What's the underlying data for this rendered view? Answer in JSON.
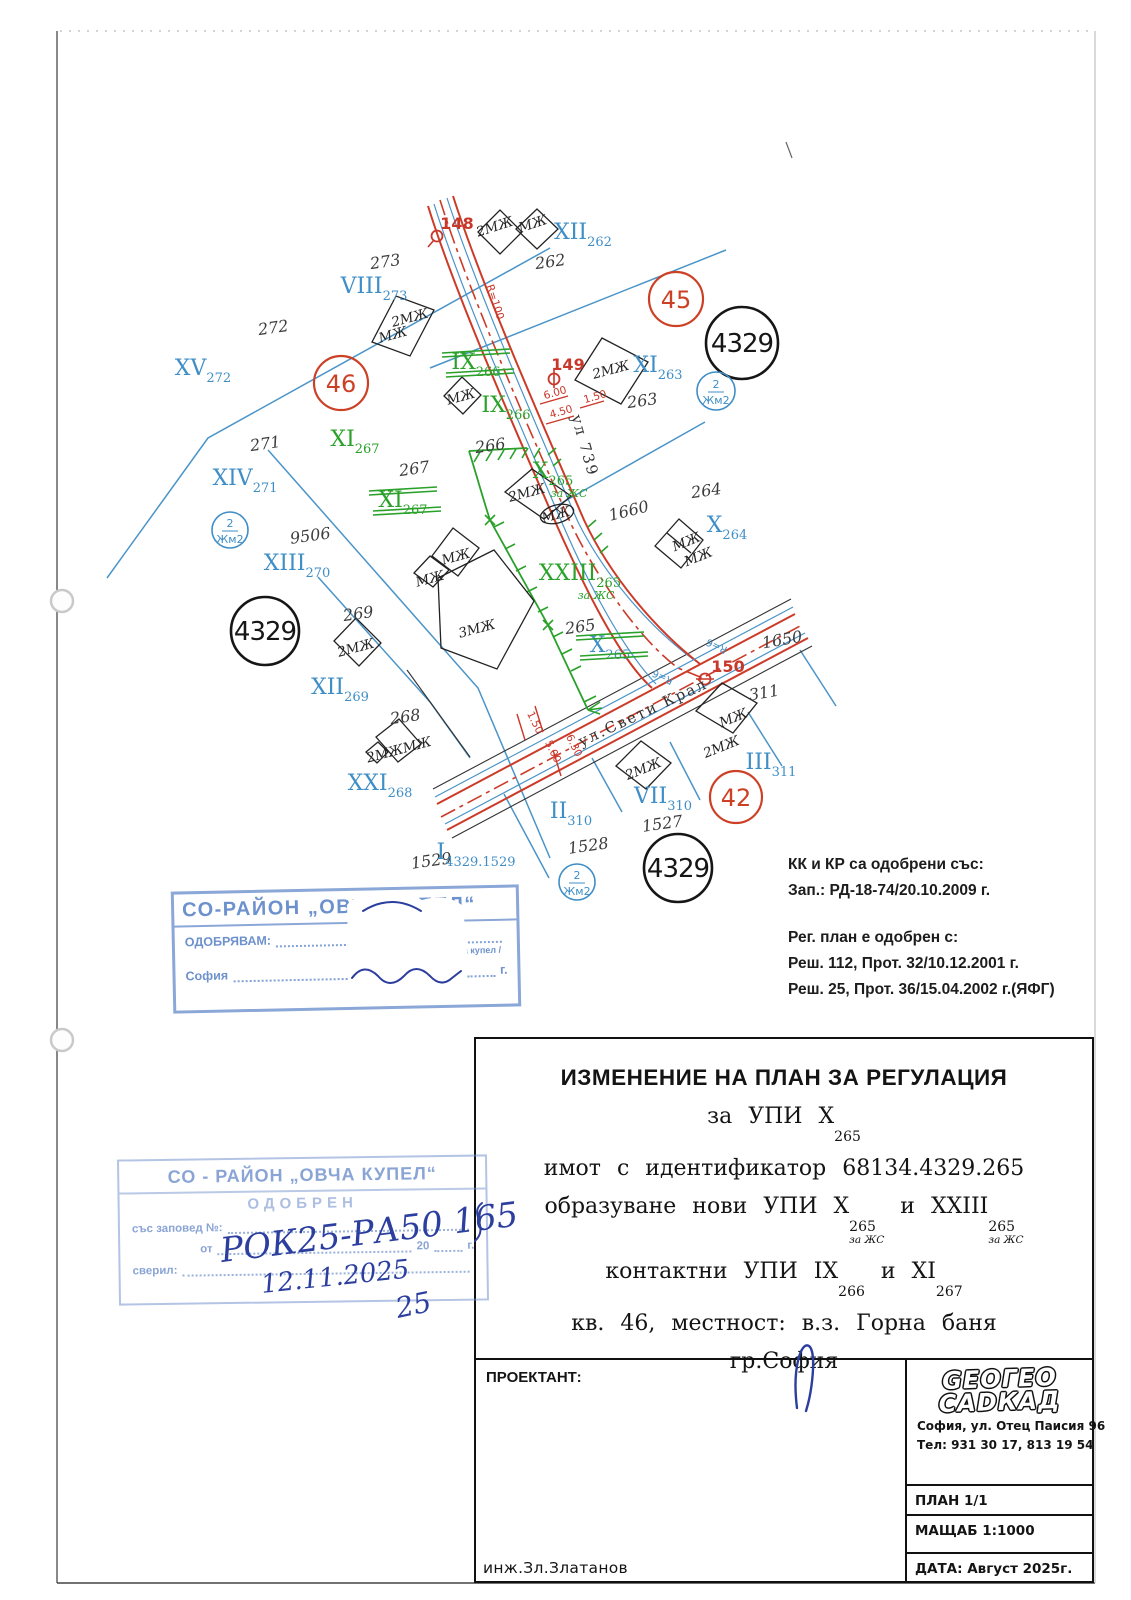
{
  "map": {
    "parcel_numbers": [
      {
        "t": "262",
        "x": 551,
        "y": 267
      },
      {
        "t": "263",
        "x": 643,
        "y": 406
      },
      {
        "t": "264",
        "x": 707,
        "y": 496
      },
      {
        "t": "265",
        "x": 581,
        "y": 632
      },
      {
        "t": "266",
        "x": 491,
        "y": 451
      },
      {
        "t": "267",
        "x": 415,
        "y": 474
      },
      {
        "t": "268",
        "x": 406,
        "y": 722
      },
      {
        "t": "269",
        "x": 359,
        "y": 619
      },
      {
        "t": "271",
        "x": 266,
        "y": 449
      },
      {
        "t": "272",
        "x": 274,
        "y": 333
      },
      {
        "t": "273",
        "x": 386,
        "y": 267
      },
      {
        "t": "9506",
        "x": 311,
        "y": 541
      },
      {
        "t": "1650",
        "x": 783,
        "y": 645,
        "r": -10
      },
      {
        "t": "1660",
        "x": 630,
        "y": 516,
        "r": -14
      },
      {
        "t": "311",
        "x": 765,
        "y": 698,
        "r": -10
      },
      {
        "t": "1527",
        "x": 663,
        "y": 829
      },
      {
        "t": "1528",
        "x": 589,
        "y": 851
      },
      {
        "t": "1529",
        "x": 432,
        "y": 866
      }
    ],
    "building_labels": [
      {
        "t": "2МЖ",
        "x": 496,
        "y": 231,
        "r": -18
      },
      {
        "t": "МЖ",
        "x": 534,
        "y": 228,
        "r": -18
      },
      {
        "t": "2МЖ",
        "x": 411,
        "y": 322,
        "r": -15
      },
      {
        "t": "МЖ",
        "x": 394,
        "y": 339,
        "r": -15
      },
      {
        "t": "МЖ",
        "x": 462,
        "y": 401,
        "r": -15
      },
      {
        "t": "2МЖ",
        "x": 612,
        "y": 374,
        "r": -15
      },
      {
        "t": "2МЖ",
        "x": 528,
        "y": 497,
        "r": -15
      },
      {
        "t": "МЖ",
        "x": 557,
        "y": 519,
        "r": -15
      },
      {
        "t": "МЖ",
        "x": 457,
        "y": 561,
        "r": -15
      },
      {
        "t": "МЖ",
        "x": 431,
        "y": 583,
        "r": -15
      },
      {
        "t": "3МЖ",
        "x": 478,
        "y": 633,
        "r": -15,
        "fs": 15
      },
      {
        "t": "2МЖ",
        "x": 357,
        "y": 652,
        "r": -15
      },
      {
        "t": "2МЖМЖ",
        "x": 400,
        "y": 754,
        "r": -15
      },
      {
        "t": "МЖ",
        "x": 688,
        "y": 546,
        "r": -22
      },
      {
        "t": "МЖ",
        "x": 700,
        "y": 561,
        "r": -22
      },
      {
        "t": "МЖ",
        "x": 735,
        "y": 722,
        "r": -22
      },
      {
        "t": "2МЖ",
        "x": 723,
        "y": 751,
        "r": -22
      },
      {
        "t": "2МЖ",
        "x": 645,
        "y": 773,
        "r": -22
      }
    ],
    "roman_labels": [
      {
        "m": "XII",
        "s": "262",
        "x": 583,
        "y": 239,
        "c": "b"
      },
      {
        "m": "VIII",
        "s": "273",
        "x": 374,
        "y": 293,
        "c": "b"
      },
      {
        "m": "XV",
        "s": "272",
        "x": 203,
        "y": 375,
        "c": "b"
      },
      {
        "m": "XIV",
        "s": "271",
        "x": 245,
        "y": 485,
        "c": "b"
      },
      {
        "m": "XIII",
        "s": "270",
        "x": 297,
        "y": 570,
        "c": "b"
      },
      {
        "m": "XII",
        "s": "269",
        "x": 340,
        "y": 694,
        "c": "b"
      },
      {
        "m": "XXI",
        "s": "268",
        "x": 380,
        "y": 790,
        "c": "b"
      },
      {
        "m": "XI",
        "s": "263",
        "x": 658,
        "y": 372,
        "c": "b"
      },
      {
        "m": "X",
        "s": "264",
        "x": 727,
        "y": 532,
        "c": "b"
      },
      {
        "m": "III",
        "s": "311",
        "x": 771,
        "y": 769,
        "c": "b"
      },
      {
        "m": "VII",
        "s": "310",
        "x": 663,
        "y": 803,
        "c": "b"
      },
      {
        "m": "II",
        "s": "310",
        "x": 571,
        "y": 818,
        "c": "b"
      },
      {
        "m": "I",
        "s": "4329.1529",
        "x": 476,
        "y": 859,
        "c": "b"
      },
      {
        "m": "X",
        "s": "265",
        "x": 610,
        "y": 652,
        "c": "b",
        "k": true
      },
      {
        "m": "IX",
        "s": "266",
        "x": 506,
        "y": 412,
        "c": "g"
      },
      {
        "m": "X",
        "s": "265",
        "x": 553,
        "y": 478,
        "c": "g",
        "e": "за ЖС"
      },
      {
        "m": "XXIII",
        "s": "265",
        "x": 580,
        "y": 580,
        "c": "g",
        "e": "за ЖС"
      },
      {
        "m": "XI",
        "s": "267",
        "x": 355,
        "y": 446,
        "c": "g"
      },
      {
        "m": "IX",
        "s": "266",
        "x": 476,
        "y": 369,
        "c": "g",
        "k": true
      },
      {
        "m": "XI",
        "s": "267",
        "x": 403,
        "y": 507,
        "c": "g",
        "k": true
      }
    ],
    "circled_black": [
      {
        "t": "4329",
        "x": 742,
        "y": 343,
        "r": 36
      },
      {
        "t": "4329",
        "x": 265,
        "y": 631,
        "r": 34
      },
      {
        "t": "4329",
        "x": 678,
        "y": 868,
        "r": 34
      }
    ],
    "circled_red": [
      {
        "t": "46",
        "x": 341,
        "y": 383,
        "r": 27
      },
      {
        "t": "45",
        "x": 676,
        "y": 299,
        "r": 27
      },
      {
        "t": "42",
        "x": 736,
        "y": 797,
        "r": 26
      }
    ],
    "circled_blue": [
      {
        "top": "2",
        "bottom": "Жм2",
        "x": 716,
        "y": 391,
        "r": 19
      },
      {
        "top": "2",
        "bottom": "Жм2",
        "x": 230,
        "y": 530,
        "r": 18
      },
      {
        "top": "2",
        "bottom": "Жм2",
        "x": 577,
        "y": 882,
        "r": 18
      }
    ],
    "survey_points": [
      {
        "t": "148",
        "x": 457,
        "y": 229,
        "mx": 437,
        "my": 236,
        "type": "q"
      },
      {
        "t": "149",
        "x": 568,
        "y": 370,
        "mx": 554,
        "my": 379,
        "type": "phi"
      },
      {
        "t": "150",
        "x": 728,
        "y": 672,
        "mx": 705,
        "my": 679,
        "type": "dash"
      }
    ],
    "dimensions": [
      {
        "t": "R=100",
        "x": 492,
        "y": 303,
        "r": 72
      },
      {
        "t": "6.00",
        "x": 556,
        "y": 396,
        "r": -16
      },
      {
        "t": "4.50",
        "x": 562,
        "y": 415,
        "r": -16
      },
      {
        "t": "1.50",
        "x": 596,
        "y": 400,
        "r": -16
      },
      {
        "t": "1.50",
        "x": 532,
        "y": 724,
        "r": 64
      },
      {
        "t": "5.00",
        "x": 550,
        "y": 753,
        "r": 64
      },
      {
        "t": "6.30",
        "x": 571,
        "y": 747,
        "r": 64
      }
    ],
    "street_names": [
      {
        "t": "ул 739",
        "x": 580,
        "y": 447,
        "r": 74
      },
      {
        "t": "ул.Свети Крал",
        "x": 645,
        "y": 717,
        "r": -25
      }
    ],
    "radius_labels": [
      {
        "t": "R=6",
        "x": 718,
        "y": 643,
        "r": 205
      },
      {
        "t": "R=6",
        "x": 664,
        "y": 674,
        "r": 205
      }
    ]
  },
  "approvals": {
    "l1": "КК и КР са одобрени със:",
    "l2": "Зап.: РД-18-74/20.10.2009 г.",
    "l3": "Рег. план е одобрен с:",
    "l4": "Реш. 112, Прот. 32/10.12.2001 г.",
    "l5": "Реш. 25, Прот. 36/15.04.2002 г.(ЯФГ)"
  },
  "stamp1": {
    "header": "СО-РАЙОН „ОВЧА КУПЕЛ“",
    "approve_label": "ОДОБРЯВАМ:",
    "kmet_line": "кмет на СО-район Овча купел",
    "city": "София",
    "year_prefix": "20",
    "year_suffix": "г."
  },
  "stamp2": {
    "header": "СО - РАЙОН „ОВЧА КУПЕЛ“",
    "approved": "ОДОБРЕН",
    "order_label": "със заповед №:",
    "ot": "от",
    "year": "20",
    "g": "г.",
    "sveril": "сверил:"
  },
  "handwriting": {
    "hw1": "РОК25-РА50 165",
    "hw2": "12.11.2025",
    "hw3": "25"
  },
  "title_block": {
    "heading": "ИЗМЕНЕНИЕ НА ПЛАН ЗА РЕГУЛАЦИЯ",
    "lines": [
      [
        {
          "t": "за УПИ X",
          "s": "265"
        }
      ],
      [
        {
          "t": "имот с идентификатор 68134.4329.265"
        }
      ],
      [
        {
          "t": "образуване нови УПИ X",
          "s": "265",
          "s2": "за ЖС"
        },
        {
          "t": " и XXIII",
          "s": "265",
          "s2": "за ЖС"
        }
      ],
      [
        {
          "t": "контактни УПИ IX",
          "s": "266"
        },
        {
          "t": " и XI",
          "s": "267"
        }
      ],
      [
        {
          "t": "кв. 46, местност: в.з. Горна баня"
        }
      ],
      [
        {
          "t": "гр.София"
        }
      ]
    ],
    "proektant_label": "ПРОЕКТАНТ:",
    "engineer": "инж.Зл.Златанов"
  },
  "footer": {
    "logo_line1a": "GEO",
    "logo_line1b": "ГЕО",
    "logo_line2a": "CAD",
    "logo_line2b": "КАД",
    "address": "София, ул. Отец Паисия 96",
    "tel": "Тел:  931 30 17,  813 19 54",
    "plan": "ПЛАН 1/1",
    "scale": "МАЩАБ 1:1000",
    "date": "ДАТА:  Август 2025г."
  }
}
